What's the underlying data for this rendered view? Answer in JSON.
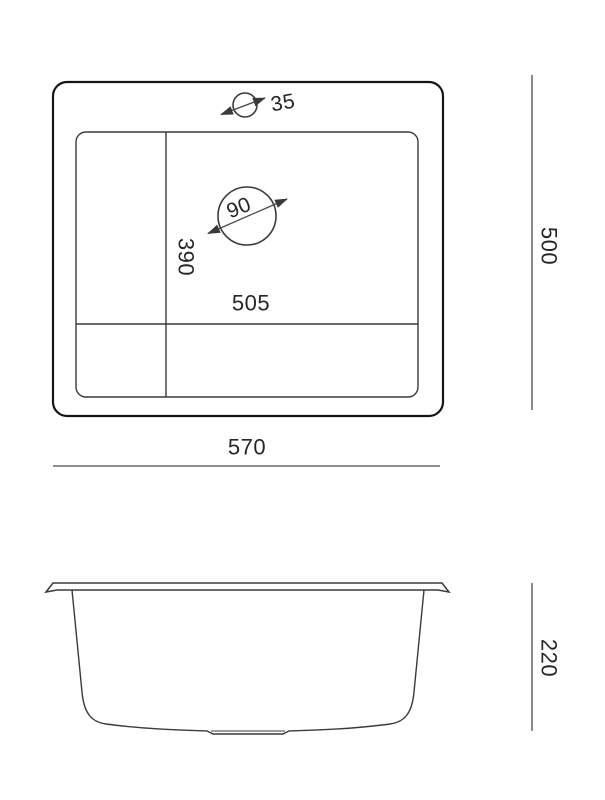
{
  "colors": {
    "background": "#ffffff",
    "line": "#3a3a3a",
    "line_strong": "#161616",
    "dim_line": "#4a4a4a",
    "text": "#262626"
  },
  "dimensions": {
    "faucet_hole_diameter": "35",
    "drain_hole_diameter": "90",
    "basin_depth": "390",
    "basin_width": "505",
    "overall_width": "570",
    "overall_depth": "500",
    "bowl_height": "220"
  }
}
